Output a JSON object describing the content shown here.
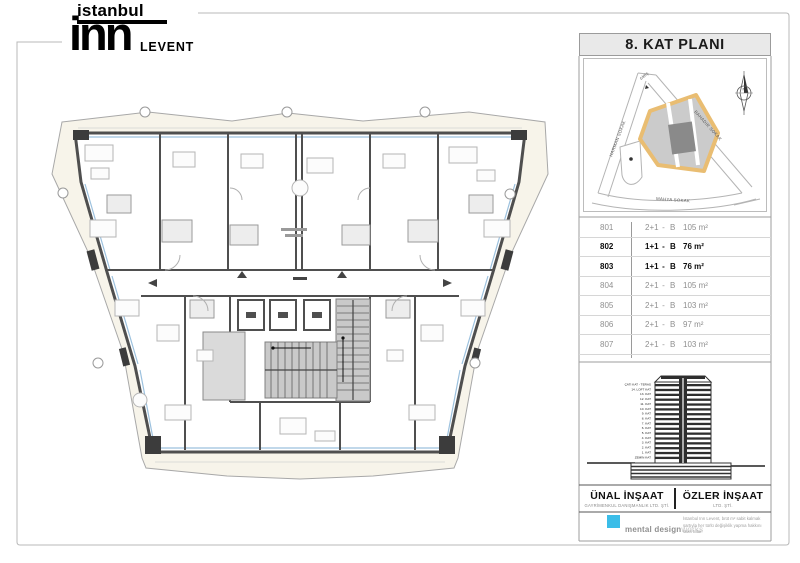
{
  "logo": {
    "top": "istanbul",
    "main": "inn",
    "sub": "LEVENT"
  },
  "panel": {
    "title": "8. KAT PLANI",
    "map": {
      "streets": [
        "HARMAN SOKAK",
        "BAHADIR SOKAK",
        "MAHYA SOKAK"
      ],
      "entrance_label": "GİRİŞ",
      "north_label": "N"
    },
    "table": {
      "rows": [
        {
          "no": "801",
          "plan": "2+1",
          "dash": "-",
          "type": "B",
          "area": "105 m²",
          "bold": false
        },
        {
          "no": "802",
          "plan": "1+1",
          "dash": "-",
          "type": "B",
          "area": "76 m²",
          "bold": true
        },
        {
          "no": "803",
          "plan": "1+1",
          "dash": "-",
          "type": "B",
          "area": "76 m²",
          "bold": true
        },
        {
          "no": "804",
          "plan": "2+1",
          "dash": "-",
          "type": "B",
          "area": "105 m²",
          "bold": false
        },
        {
          "no": "805",
          "plan": "2+1",
          "dash": "-",
          "type": "B",
          "area": "103 m²",
          "bold": false
        },
        {
          "no": "806",
          "plan": "2+1",
          "dash": "-",
          "type": "B",
          "area": "97 m²",
          "bold": false
        },
        {
          "no": "807",
          "plan": "2+1",
          "dash": "-",
          "type": "B",
          "area": "103 m²",
          "bold": false
        }
      ]
    },
    "elevation": {
      "floors": [
        "ÇATI KAT - TERAS",
        "14. LOFT KAT",
        "13. KAT",
        "12. KAT",
        "11. KAT",
        "10. KAT",
        "9. KAT",
        "8. KAT",
        "7. KAT",
        "6. KAT",
        "5. KAT",
        "4. KAT",
        "3. KAT",
        "2. KAT",
        "1. KAT",
        "ZEMİN KAT"
      ]
    },
    "companies": {
      "left": {
        "name": "ÜNAL İNŞAAT",
        "sub": "GAYRİMENKUL DANIŞMANLIK LTD. ŞTİ."
      },
      "right": {
        "name": "ÖZLER İNŞAAT",
        "sub": "LTD. ŞTİ."
      }
    },
    "credits": {
      "brand": "mental design",
      "brand_light": "works",
      "disclaimer": "İstanbul Inn Levent, brüt m² sabit kalmak şartıyla her türlü değişiklik yapma hakkını saklı tutar."
    }
  },
  "colors": {
    "accent_cyan": "#3bbde8",
    "highlight_orange": "#e9bd72",
    "wall_gray": "#4f4f4f",
    "core_gray": "#c9c9c9"
  }
}
